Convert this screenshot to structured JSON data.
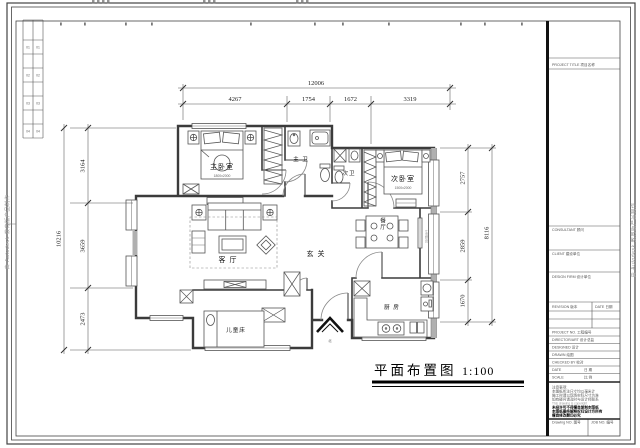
{
  "watermark": {
    "left": "由 Autodesk 教育版产品制作",
    "right": "由 Autodesk 教育版产品制作"
  },
  "drawing_title": {
    "text": "平面布置图",
    "scale": "1:100"
  },
  "north": {
    "label": "北"
  },
  "rooms": {
    "master_bedroom": {
      "label": "主卧室",
      "size": "1800x2000"
    },
    "master_bath": {
      "label": "主 卫"
    },
    "second_bath": {
      "label": "次卫"
    },
    "second_bedroom": {
      "label": "次卧室",
      "size": "1500x2000"
    },
    "living_room": {
      "label": "客 厅"
    },
    "entry": {
      "label": "玄 关"
    },
    "dining": {
      "label": "餐厅"
    },
    "kitchen": {
      "label": "厨 房"
    },
    "kids_room": {
      "label": "儿童床"
    },
    "service_balcony": {
      "label": "生活阳台"
    }
  },
  "dims": {
    "top": {
      "overall": "12006",
      "seg": [
        "4267",
        "1754",
        "1672",
        "3319"
      ]
    },
    "left": {
      "overall": "10216",
      "seg": [
        "3164",
        "3659",
        "2473"
      ]
    },
    "right": {
      "overall": "8116",
      "seg": [
        "2757",
        "2859",
        "1670"
      ]
    }
  },
  "revision_table": {
    "rows": [
      {
        "a": "01",
        "b": "01"
      },
      {
        "a": "02",
        "b": "02"
      },
      {
        "a": "03",
        "b": "03"
      },
      {
        "a": "04",
        "b": "04"
      }
    ]
  },
  "title_block": {
    "project_title": "PROJECT TITLE  项目名称",
    "consultant": "CONSULTANT  顾问",
    "client": "CLIENT  建设单位",
    "design_firm": "DESIGN FIRM  设计单位",
    "revision": "REVISION  版本",
    "rev_date": "DATE  日期",
    "project_no": "PROJECT NO.  工程编号",
    "director": "DIRECTOR/ART  设计总监",
    "designer": "DESIGNED  设计",
    "drawn": "DRAWN  绘图",
    "checked": "CHECKED BY  校对",
    "date_label": "DATE",
    "date_cn": "日  期",
    "scale_label": "SCALE",
    "scale_cn": "比  例",
    "notes": [
      "注意事项:",
      "本图纸所注尺寸均以毫米计",
      "施工时请以现场实际尺寸为准",
      "如有疑问请及时与设计师联系",
      "This drawing is copyright",
      "未经许可不得擅自复制本图纸",
      "本图纸最终解释权归设计方所有",
      "擅自修改翻印必究"
    ],
    "drawing_no": "Drawing NO.  图号",
    "job_no": "JOB NO.  编号"
  }
}
